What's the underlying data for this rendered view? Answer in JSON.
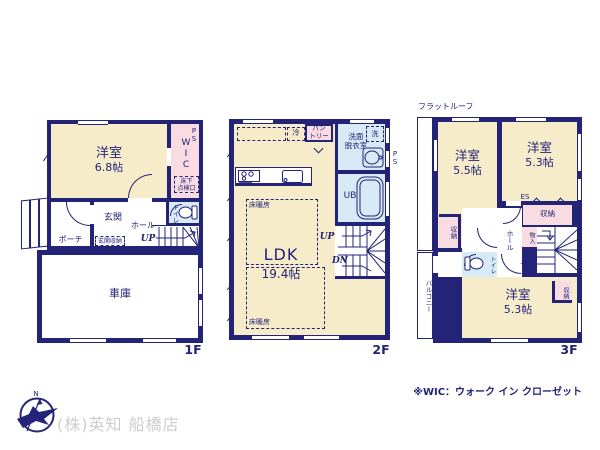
{
  "colors": {
    "wall": "#232378",
    "room_cream": "#f7ecca",
    "room_pink": "#f8dce2",
    "room_blue": "#d8eaf5",
    "text_navy": "#232378",
    "brand_gray": "#cdcdcd"
  },
  "f1": {
    "label": "1F",
    "yoshitsu": "洋室",
    "yoshitsu_size": "6.8帖",
    "wic": "WIC",
    "ps": "PS",
    "yukashita": "床下\n点検口",
    "genkan": "玄関",
    "genkan_shuno": "玄関収納",
    "hall": "ホール",
    "up": "UP",
    "porch": "ポーチ",
    "toilet": "トイレ",
    "garage": "車庫"
  },
  "f2": {
    "label": "2F",
    "ldk": "LDK",
    "ldk_size": "19.4帖",
    "rei": "冷",
    "pantry": "パン\nトリー",
    "senmen": "洗面\n脱衣室",
    "sen": "洗",
    "ps": "PS",
    "ub": "UB",
    "yukadan1": "床暖房",
    "yukadan2": "床暖房",
    "up": "UP",
    "dn": "DN"
  },
  "f3": {
    "label": "3F",
    "flat_roof": "フラットルーフ",
    "y55": "洋室",
    "y55_size": "5.5帖",
    "y53a": "洋室",
    "y53a_size": "5.3帖",
    "y53b": "洋室",
    "y53b_size": "5.3帖",
    "es": "ES",
    "shuno_top": "収納",
    "shuno_left": "収納",
    "shuno_small": "収納",
    "mono": "物入",
    "hall": "ホール",
    "dn": "DN",
    "toilet": "トイレ",
    "balcony": "バルコニー"
  },
  "footer": {
    "company": "(株)英知 船橋店",
    "note": "※WIC：ウォーク イン クローゼット",
    "compass_n": "N"
  }
}
